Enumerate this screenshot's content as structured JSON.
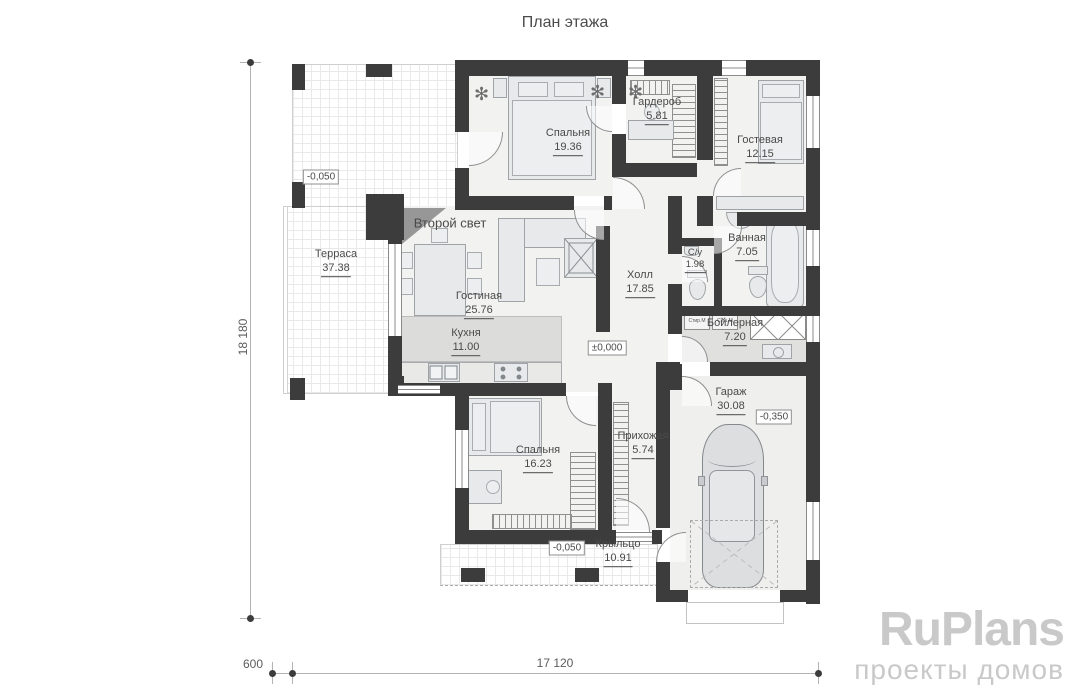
{
  "title": "План этажа",
  "rooms": {
    "bedroom1": {
      "name": "Спальня",
      "area": "19.36"
    },
    "wardrobe": {
      "name": "Гардероб",
      "area": "5.81"
    },
    "guest": {
      "name": "Гостевая",
      "area": "12.15"
    },
    "terrace": {
      "name": "Терраса",
      "area": "37.38"
    },
    "second_light": {
      "name": "Второй свет"
    },
    "living": {
      "name": "Гостиная",
      "area": "25.76"
    },
    "kitchen": {
      "name": "Кухня",
      "area": "11.00"
    },
    "hall": {
      "name": "Холл",
      "area": "17.85"
    },
    "wc": {
      "name": "С/у",
      "area": "1.98"
    },
    "bathroom": {
      "name": "Ванная",
      "area": "7.05"
    },
    "boiler": {
      "name": "Бойлерная",
      "area": "7.20"
    },
    "garage": {
      "name": "Гараж",
      "area": "30.08"
    },
    "bedroom2": {
      "name": "Спальня",
      "area": "16.23"
    },
    "entry_hall": {
      "name": "Прихожая",
      "area": "5.74"
    },
    "porch": {
      "name": "Крыльцо",
      "area": "10.91"
    }
  },
  "elevations": {
    "terrace": "-0,050",
    "hall": "±0,000",
    "garage": "-0,350",
    "porch": "-0,050"
  },
  "dimensions": {
    "left_height": "18 180",
    "bottom_width": "17 120",
    "bottom_offset": "600"
  },
  "appliances": {
    "washer": "Стир.М",
    "dryer": "Суш.М"
  },
  "logo": {
    "brand": "RuPlans",
    "tagline": "проекты домов"
  },
  "colors": {
    "wall": "#3c3c3c",
    "floor": "#f2f2f1",
    "logo_gray": "#c9c9c9"
  }
}
